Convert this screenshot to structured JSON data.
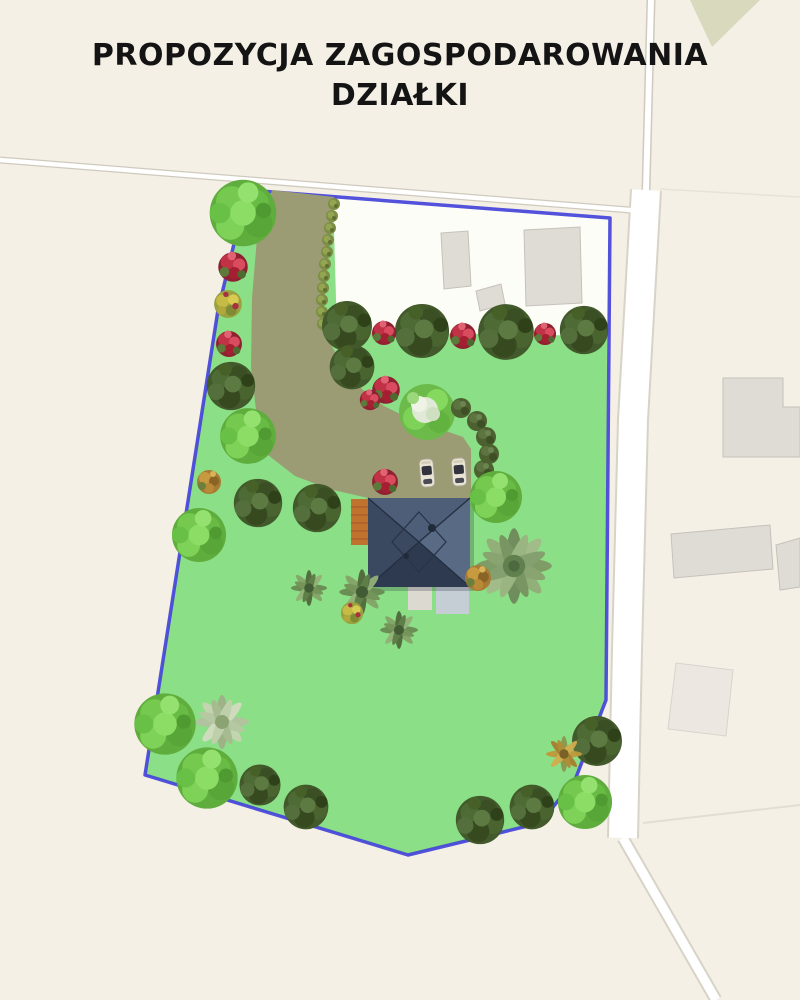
{
  "title": {
    "line1": "PROPOZYCJA ZAGOSPODAROWANIA",
    "line2": "DZIAŁKI"
  },
  "plan": {
    "type": "garden-site-plan-on-map",
    "colors": {
      "map_background": "#f4f0e6",
      "plot_boundary": "#4443da",
      "lawn": "#8bdf86",
      "unplanted_area": "#fdfdf7",
      "driveway": "#9b9c74",
      "house_roof": "#3c4a60",
      "wooden_deck": "#c0722f",
      "road": "#ffffff",
      "map_building": "#dfdbd5"
    },
    "elements": {
      "house_count": 1,
      "car_count": 2,
      "existing_buildings_on_plot": 3,
      "neighbor_buildings": 4,
      "dark_trees": 13,
      "bright_trees": 7,
      "rose_bushes": 8,
      "palm_trees": 2,
      "ornamental_grasses": 4,
      "yellow_shrubs": 2,
      "orange_shrubs": 2,
      "hedge_plants": 11,
      "border_shrubs": 5
    }
  }
}
